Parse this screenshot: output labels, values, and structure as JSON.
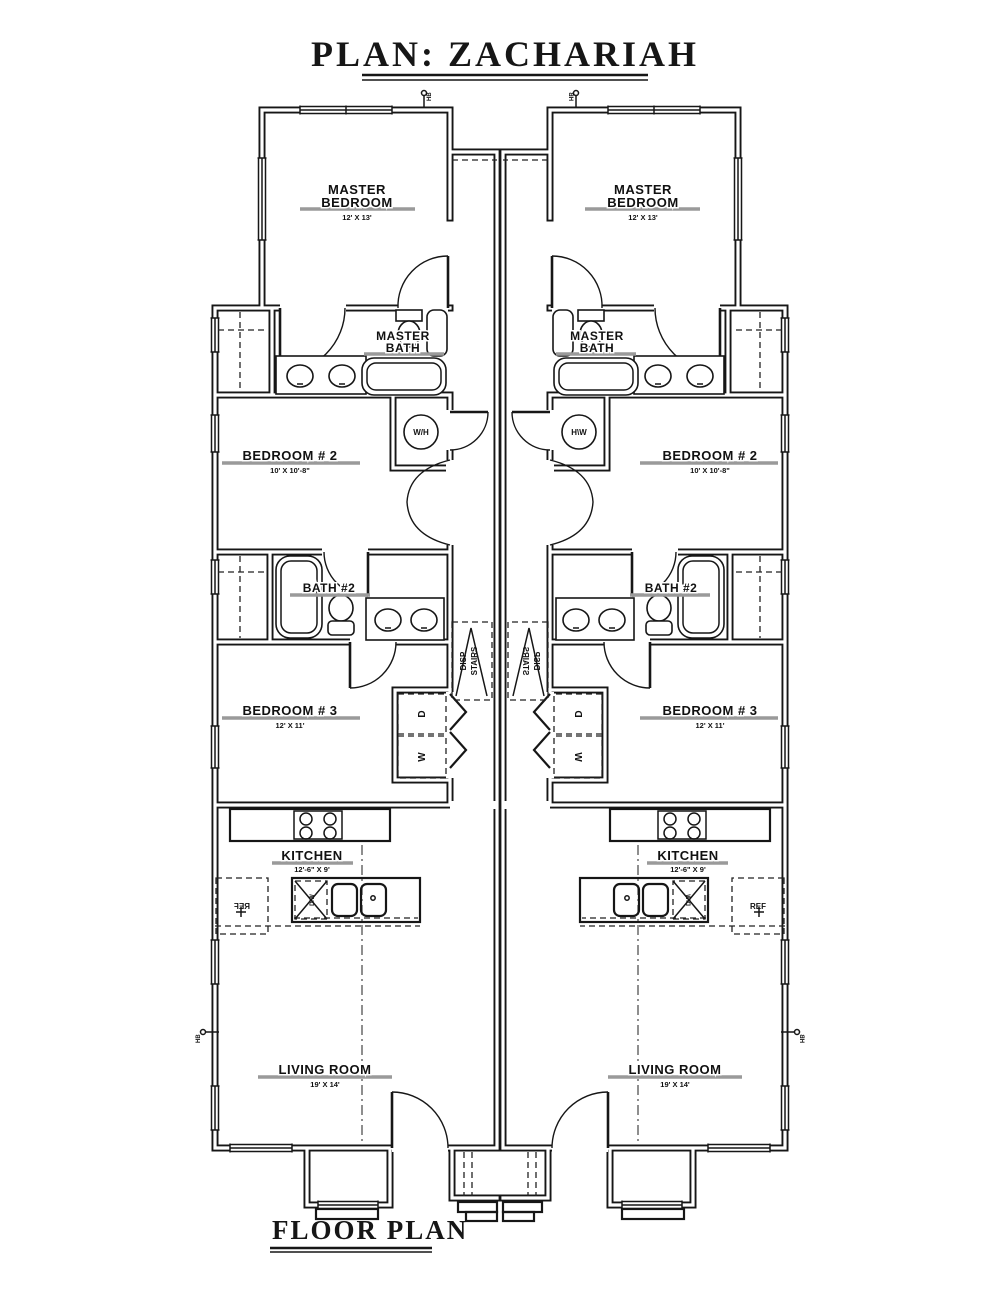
{
  "title": "PLAN: ZACHARIAH",
  "caption": "FLOOR PLAN",
  "rooms": {
    "master_bedroom": {
      "line1": "MASTER",
      "line2": "BEDROOM",
      "dims": "12' X 13'"
    },
    "master_bath": {
      "line1": "MASTER",
      "line2": "BATH"
    },
    "bedroom_2": {
      "name": "BEDROOM # 2",
      "dims": "10' X 10'-8\""
    },
    "bath_2": {
      "name": "BATH #2"
    },
    "bedroom_3": {
      "name": "BEDROOM # 3",
      "dims": "12' X 11'"
    },
    "kitchen": {
      "name": "KITCHEN",
      "dims": "12'-6\" X 9'"
    },
    "living_room": {
      "name": "LIVING ROOM",
      "dims": "19' X 14'"
    }
  },
  "fixtures": {
    "water_heater": "W/H",
    "dryer": "D",
    "washer": "W",
    "refrigerator": "REF",
    "dishwasher": "D/W",
    "attic_stairs_line1": "DISP",
    "attic_stairs_line2": "STAIRS",
    "hose_bibb": "HB"
  },
  "colors": {
    "ink": "#161616",
    "underline_gray": "#9a9a9a",
    "background": "#ffffff"
  }
}
